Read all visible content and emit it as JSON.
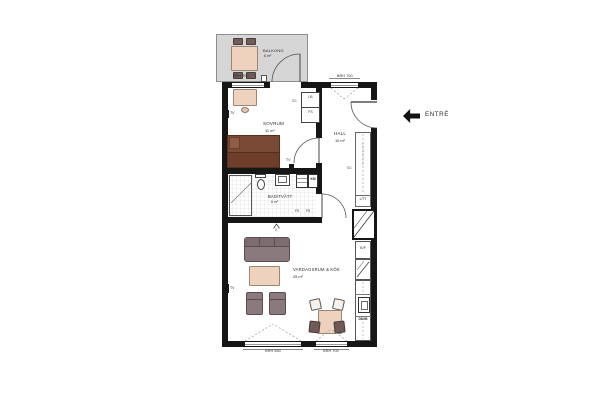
{
  "meta": {
    "type": "apartment-floor-plan"
  },
  "rooms": {
    "balkong": {
      "name": "BALKONG",
      "area": "6 m²"
    },
    "sovrum": {
      "name": "SOVRUM",
      "area": "11 m²"
    },
    "hall": {
      "name": "HALL",
      "area": "10 m²"
    },
    "bad_tvatt": {
      "name": "BAD/TVÄTT",
      "area": "6 m²"
    },
    "vardagsrum_kok": {
      "name": "VARDAGSRUM & KÖK",
      "area": "25 m²"
    }
  },
  "entry": {
    "label": "ENTRÉ"
  },
  "window_labels": {
    "balcony": "BRH 700",
    "hall": "BRH 700",
    "living_left": "BRH 550",
    "living_right": "BRH 700"
  },
  "annotations": {
    "tv": "TV",
    "section_number": "2"
  },
  "storage": {
    "bedroom_closet_top": "LB",
    "bedroom_closet_bottom": "FS",
    "bedroom_closet_side": "SG",
    "hall_wardrobe_side": "SG",
    "hall_wardrobe_shelf": "HATTHYLLA",
    "hall_wardrobe_bottom": "L/TT",
    "bath_shelf_left": "FS",
    "bath_shelf_right": "FS",
    "laundry_unit": "KM"
  },
  "kitchen": {
    "fridge_freezer": "K/F",
    "appliance": "DM/M"
  },
  "colors": {
    "wall": "#161616",
    "balcony_floor": "#d6d6d6",
    "wood": "#eed2be",
    "bed": "#7b4a37",
    "upholstery": "#8b7a7d",
    "dark_chairs": "#6e5d59"
  }
}
